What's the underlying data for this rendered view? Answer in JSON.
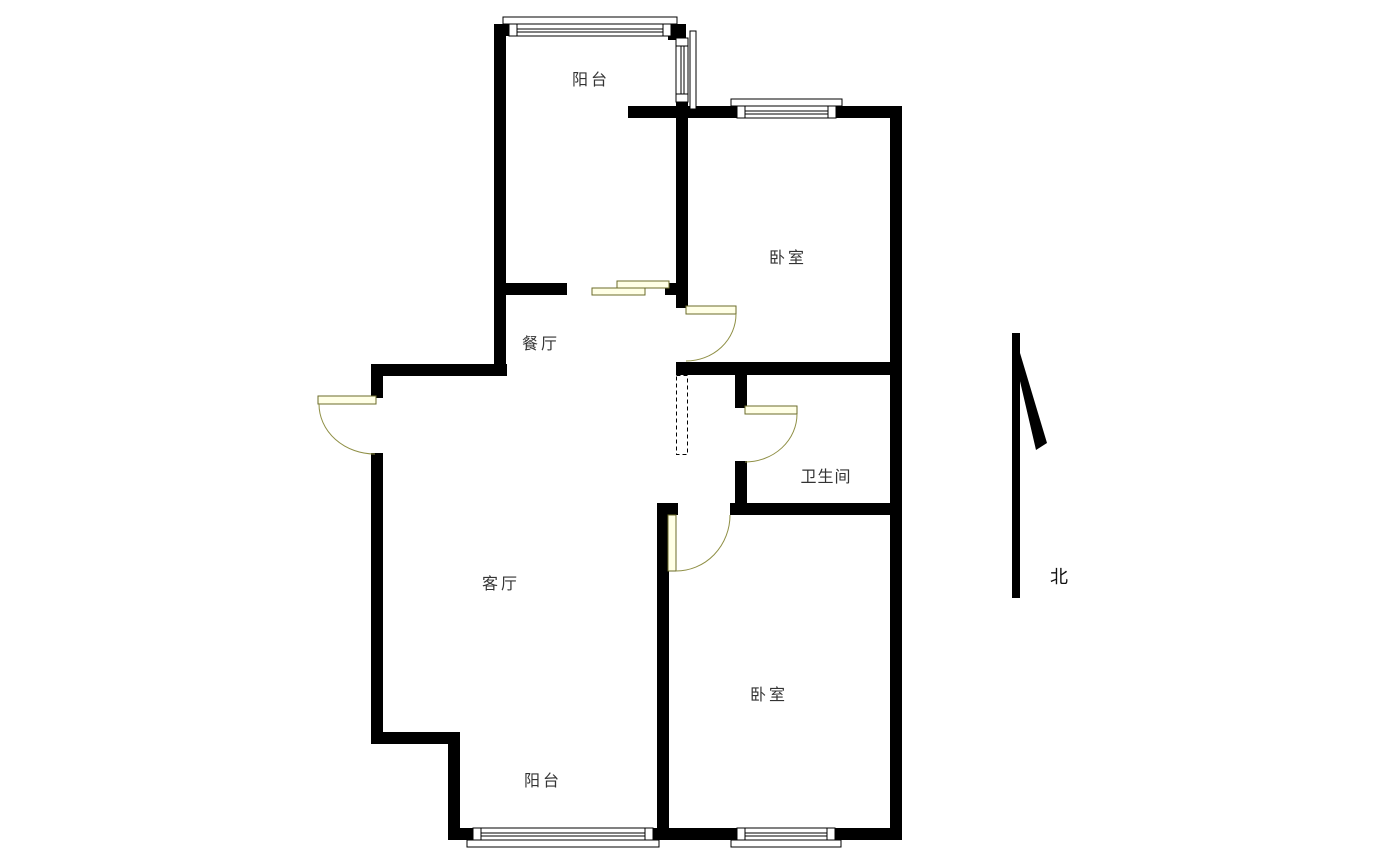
{
  "page": {
    "width": 1385,
    "height": 862,
    "background": "#ffffff"
  },
  "plan": {
    "type": "apartment-floor-plan",
    "rooms": [
      {
        "id": "balcony-top",
        "label": "阳台"
      },
      {
        "id": "bedroom-top",
        "label": "卧室"
      },
      {
        "id": "dining-room",
        "label": "餐厅"
      },
      {
        "id": "living-room",
        "label": "客厅"
      },
      {
        "id": "bathroom",
        "label": "卫生间"
      },
      {
        "id": "bedroom-bottom",
        "label": "卧室"
      },
      {
        "id": "balcony-bottom",
        "label": "阳台"
      }
    ],
    "compass": {
      "label": "北",
      "direction": "up"
    },
    "colors": {
      "wall": "#000000",
      "door_leaf_fill": "#ffffe6",
      "door_outline": "#6b6b2a",
      "door_arc": "#8f8f45",
      "text": "#333333",
      "background": "#ffffff"
    },
    "symbols": {
      "doors": [
        "entry-swing-door",
        "bedroom-top-swing-door",
        "bathroom-swing-door",
        "bedroom-bottom-swing-door",
        "balcony-sliding-door"
      ],
      "windows": [
        "balcony-top-window",
        "balcony-side-window",
        "bedroom-top-window",
        "balcony-bottom-window",
        "bedroom-bottom-window"
      ],
      "other": [
        "duct-shaft-dashed",
        "north-arrow"
      ]
    }
  }
}
